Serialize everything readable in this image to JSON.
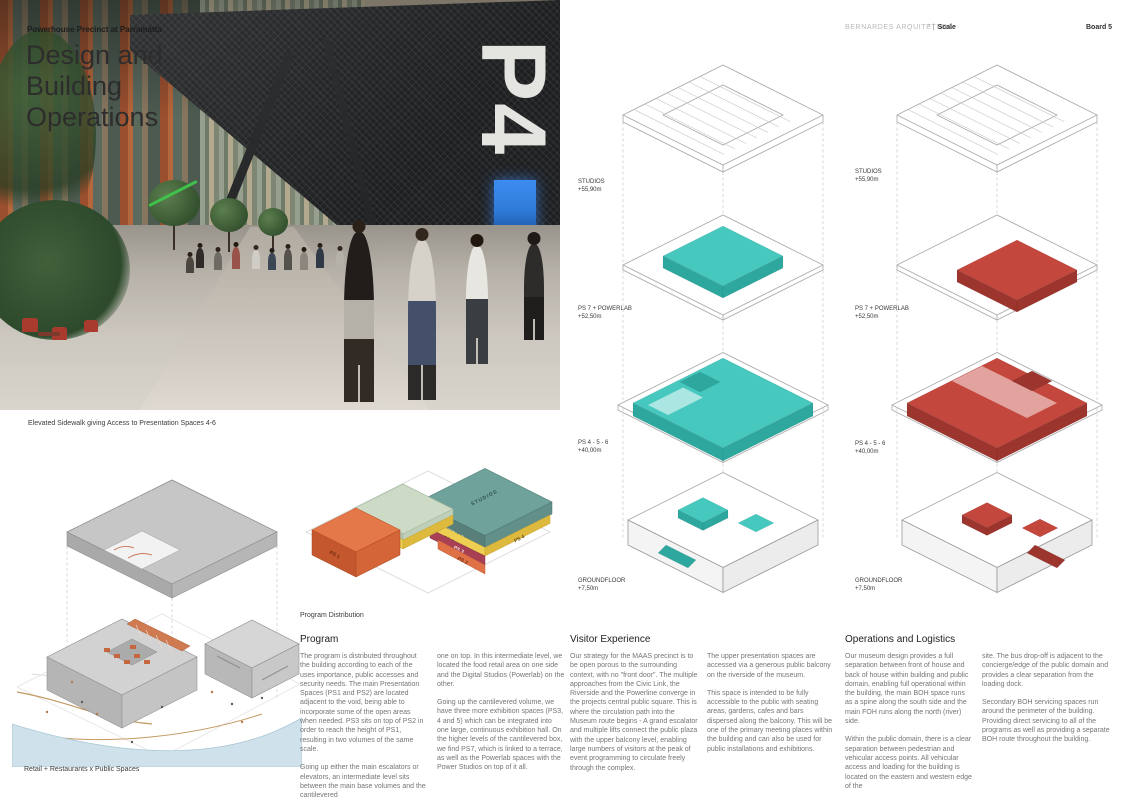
{
  "header": {
    "project_label": "Powerhouse Precinct at Parramatta",
    "title_line1": "Design and",
    "title_line2": "Building",
    "title_line3": "Operations",
    "firm": "BERNARDES ARQUITETURA",
    "divider_mark": "° |",
    "scale_label": "Scale",
    "board_label": "Board 5"
  },
  "photo": {
    "wall_text": "P4",
    "caption": "Elevated Sidewalk giving Access to Presentation Spaces 4-6"
  },
  "levels": [
    {
      "name": "STUDIOS",
      "elev": "+55,90m"
    },
    {
      "name": "PS 7 + POWERLAB",
      "elev": "+52,50m"
    },
    {
      "name": "PS 4 - 5 - 6",
      "elev": "+40,00m"
    },
    {
      "name": "GROUNDFLOOR",
      "elev": "+7,50m"
    }
  ],
  "program_axon": {
    "caption": "Program Distribution",
    "blocks": {
      "studios": "STUDIOS",
      "powerlab": "POWERLAB",
      "ps7": "PS 7",
      "ps6": "PS 6",
      "ps5": "PS 5",
      "ps4": "PS 4",
      "ps3": "PS 3",
      "ps2": "PS 2",
      "ps1": "PS 1"
    }
  },
  "site_axon": {
    "caption": "Retail + Restaurants x Public Spaces"
  },
  "sections": {
    "program": {
      "heading": "Program",
      "p1": "The program is distributed throughout the building according to each of the uses importance, public accesses and security needs. The main Presentation Spaces (PS1 and PS2) are located adjacent to the void, being able to incorporate some of the open areas when needed. PS3 sits on top of PS2 in order to reach the height of PS1, resulting in two volumes of the same scale.",
      "p2": "Going up either the main escalators or elevators, an intermediate level sits between the main base volumes and the cantilevered",
      "p3": "one on top. In this intermediate level, we located the food retail area on one side and the Digital Studios (Powerlab) on the other.",
      "p4": "Going up the cantilevered volume, we have three more exhibition spaces (PS3, 4 and 5) which can be integrated into one large, continuous exhibition hall. On the higher levels of the cantilevered box, we find PS7, which is linked to a terrace, as well as the Powerlab spaces with the Power Studios on top of it all."
    },
    "visitor": {
      "heading": "Visitor Experience",
      "p1": "Our strategy for the MAAS precinct is to be open porous to the surrounding context, with no \"front door\". The multiple approaches from the Civic Link, the Riverside and the Powerline converge in the projects central public square. This is where the circulation path into the Museum route begins - A grand escalator and multiple lifts connect the public plaza with the upper balcony level, enabling large numbers of visitors at the peak of event programming to circulate freely through the complex.",
      "p2": "The upper presentation spaces are accessed via a generous public balcony on the riverside of the museum.",
      "p3": "This space is intended to be fully accessible to the public with seating areas, gardens, cafes and bars dispersed along the balcony. This will be one of the primary meeting places within the building and can also be used for public installations and exhibitions."
    },
    "operations": {
      "heading": "Operations and Logistics",
      "p1": "Our museum design provides a full separation between front of house and back of house within building and public domain, enabling full operational within the building, the main BOH space runs as a spine along the south side and the main FOH runs along the north (river) side.",
      "p2": "Within the public domain, there is a clear separation between pedestrian and vehicular access points. All vehicular access and loading for the building is located on the eastern and western edge of the",
      "p3": "site. The bus drop-off is adjacent to the concierge/edge of the public domain and provides a clear separation from the loading dock.",
      "p4": "Secondary BOH servicing spaces run around the perimeter of the building. Providing direct servicing to all of the programs as well as providing a separate BOH route throughout the building."
    }
  },
  "colors": {
    "teal": "#46c8bf",
    "teal_dark": "#2ea79f",
    "red": "#c4473d",
    "red_dark": "#9c352d",
    "orange": "#e07147",
    "yellow": "#efcf52",
    "light_green": "#cddbc6",
    "slab_teal": "#6fa29b",
    "slab_teal_dark": "#587f79",
    "maroon": "#a84055",
    "gray_slab": "#c6c6c6",
    "river": "#cfe2eb",
    "path_tan": "#c49a62",
    "green_accent": "#3fc24b",
    "door_blue": "#2e7bd8"
  }
}
